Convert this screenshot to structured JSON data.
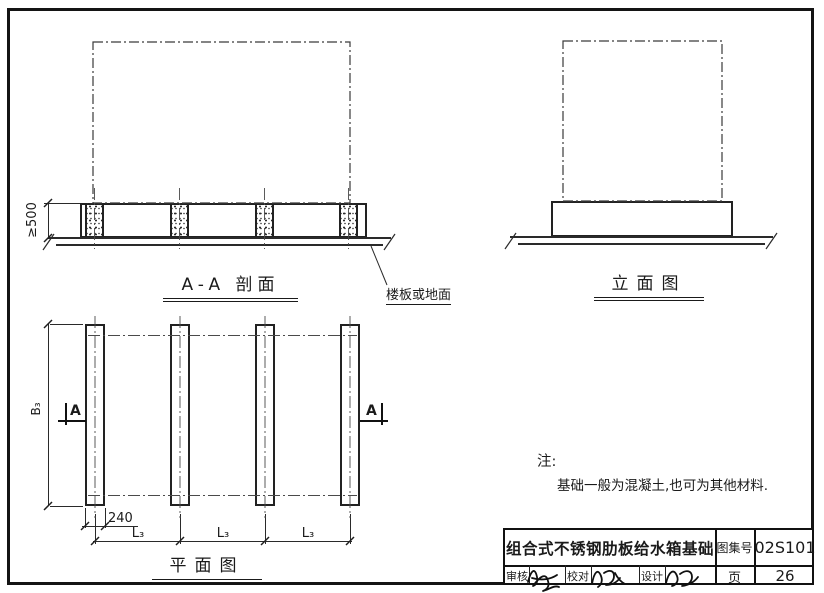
{
  "drawing": {
    "section": {
      "title": "A-A 剖面",
      "height_dim": "≥500",
      "leader_label": "楼板或地面"
    },
    "elevation": {
      "title": "立面图"
    },
    "plan": {
      "title": "平面图",
      "width_dim": "B₃",
      "strip_width_dim": "240",
      "spacing_dims": [
        "L₃",
        "L₃",
        "L₃"
      ],
      "section_mark": "A"
    },
    "notes": {
      "heading": "注:",
      "body": "基础一般为混凝土,也可为其他材料."
    }
  },
  "title_block": {
    "title": "组合式不锈钢肋板给水箱基础",
    "atlas_label": "图集号",
    "atlas_no": "02S101",
    "review_label": "审核",
    "check_label": "校对",
    "design_label": "设计",
    "page_label": "页",
    "page_no": "26"
  },
  "colors": {
    "ink": "#1a1a1a",
    "paper": "#ffffff"
  }
}
